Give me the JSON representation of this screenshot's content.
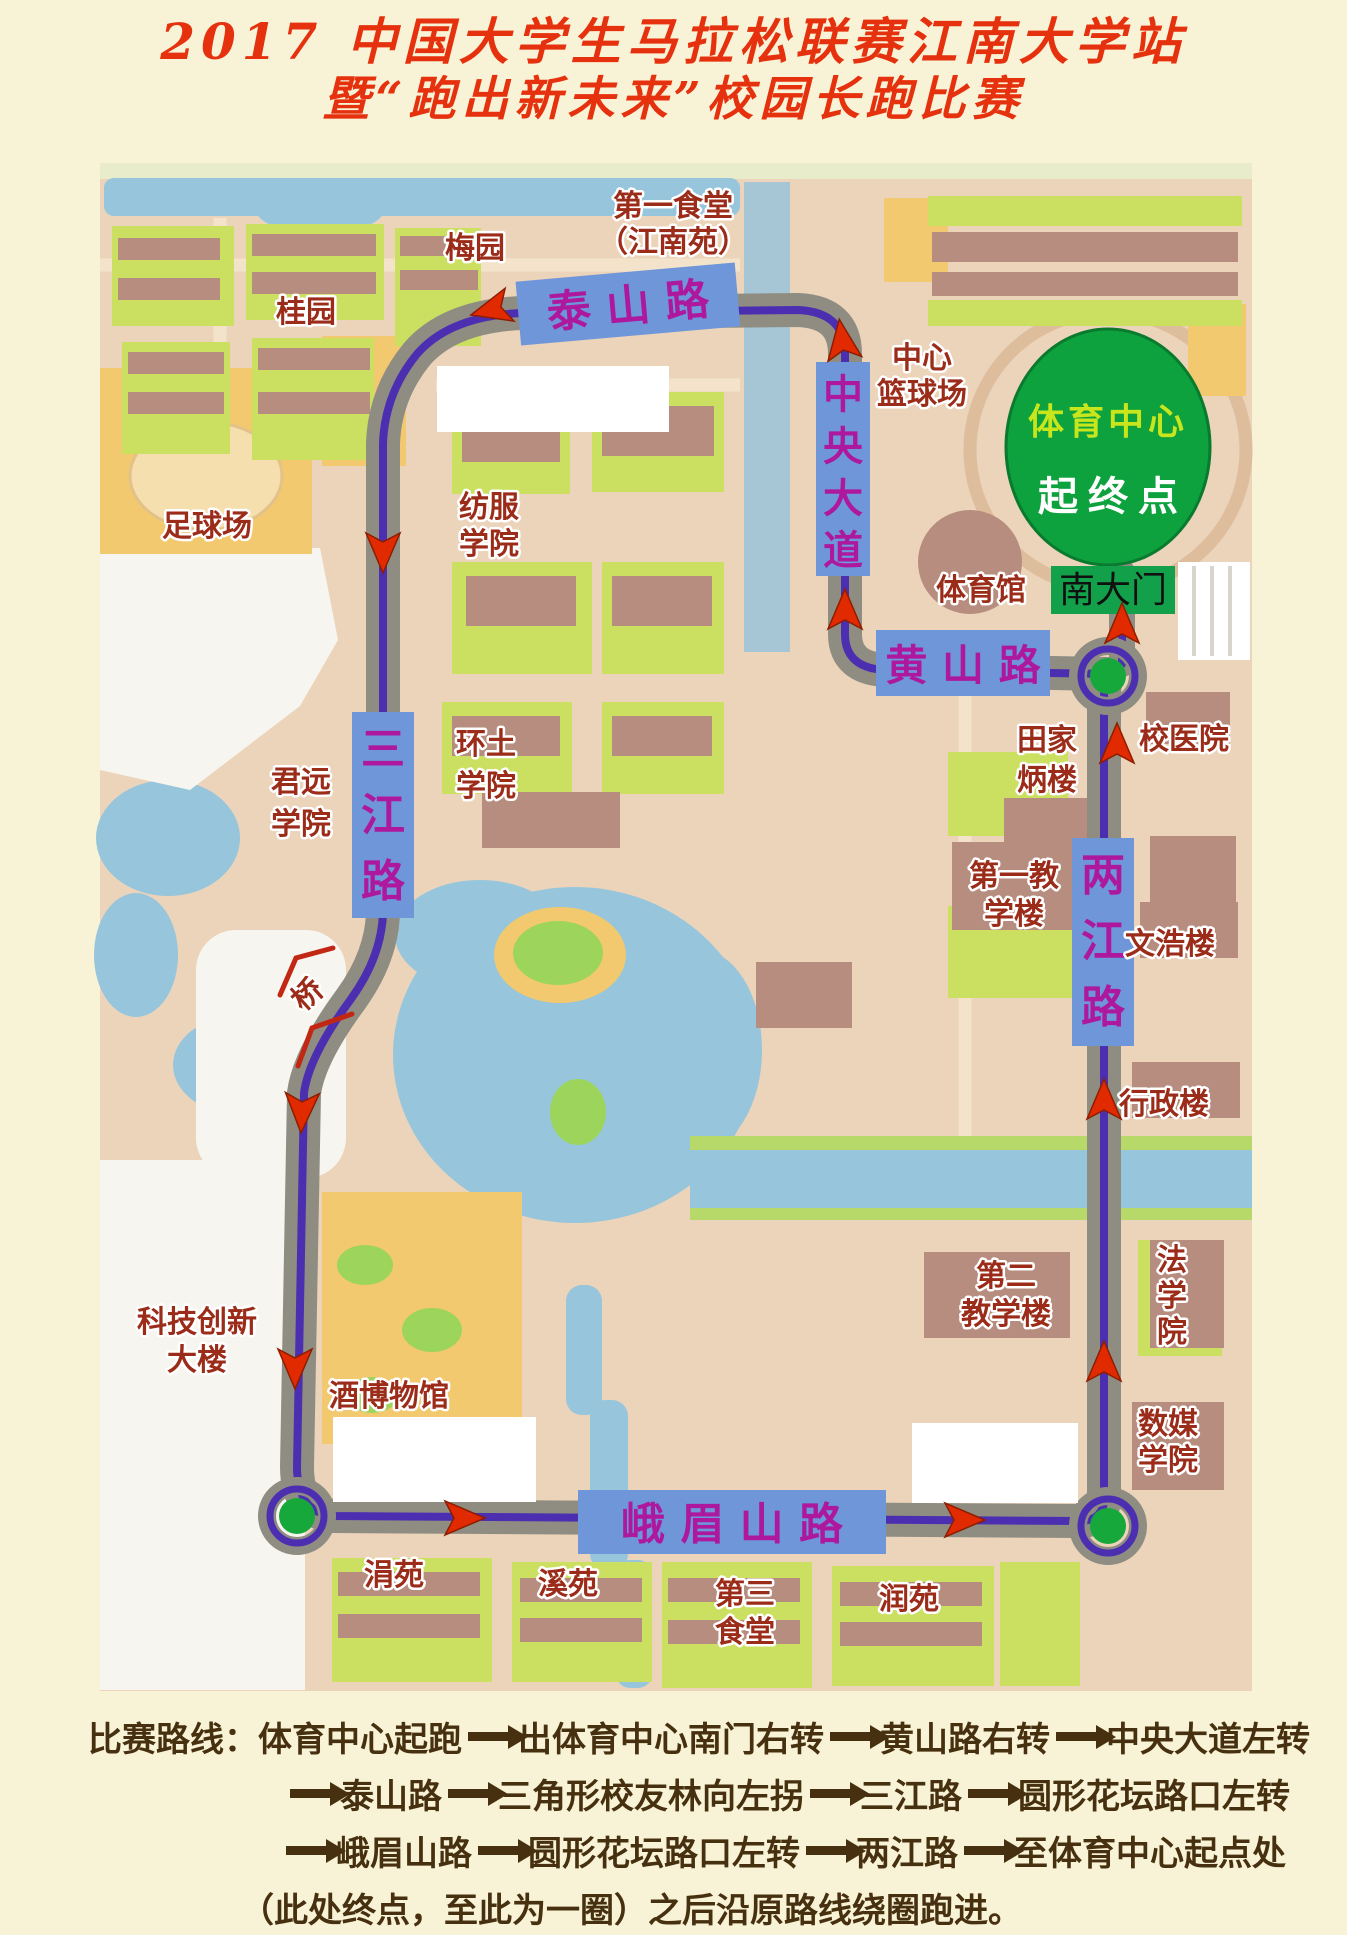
{
  "title": {
    "line1": "2017 中国大学生马拉松联赛江南大学站",
    "line2": "暨“跑出新未来”校园长跑比赛"
  },
  "colors": {
    "title_red": "#e5310e",
    "banner_blue": "#6f96d9",
    "banner_text_magenta": "#ad189e",
    "place_label_maroon": "#9c2c1a",
    "route_purple": "#4b2fb0",
    "road_gray": "#8f8d82",
    "arrow_red": "#e22a00",
    "start_finish_green": "#0da23e",
    "south_gate_green": "#13a04a",
    "footer_text_brown": "#46300f"
  },
  "map": {
    "start_finish": {
      "line1": "体育中心",
      "line2": "起终点"
    },
    "south_gate": "南大门",
    "roads": {
      "taishan": "泰 山 路",
      "zhongyang": [
        "中",
        "央",
        "大",
        "道"
      ],
      "huangshan": "黄 山 路",
      "sanjiang": [
        "三",
        "江",
        "路"
      ],
      "liangjiang": [
        "两",
        "江",
        "路"
      ],
      "emeishan": "峨 眉 山 路"
    },
    "places": {
      "meiyuan": "梅园",
      "guiyuan": "桂园",
      "shitang1a": "第一食堂",
      "shitang1b": "（江南苑）",
      "lanqiu1": "中心",
      "lanqiu2": "篮球场",
      "zuqiuchang": "足球场",
      "fangfu1": "纺服",
      "fangfu2": "学院",
      "tiyuguan": "体育馆",
      "junyuan1": "君远",
      "junyuan2": "学院",
      "huantu1": "环土",
      "huantu2": "学院",
      "tianjiabing1": "田家",
      "tianjiabing2": "炳楼",
      "xiaoyiyuan": "校医院",
      "qiao": "桥",
      "jiao1a": "第一教",
      "jiao1b": "学楼",
      "wenhaolou": "文浩楼",
      "xingzhenglou": "行政楼",
      "jiao2a": "第二",
      "jiao2b": "教学楼",
      "fa1": "法",
      "fa2": "学",
      "fa3": "院",
      "keji1": "科技创新",
      "keji2": "大楼",
      "jiubowuguan": "酒博物馆",
      "shumei1": "数媒",
      "shumei2": "学院",
      "juanyuan": "涓苑",
      "xiyuan": "溪苑",
      "shitang3a": "第三",
      "shitang3b": "食堂",
      "runyuan": "润苑"
    }
  },
  "route_plan": {
    "prefix": "比赛路线：",
    "line1": [
      "体育中心起跑",
      "出体育中心南门右转",
      "黄山路右转",
      "中央大道左转"
    ],
    "line2": [
      "泰山路",
      "三角形校友林向左拐",
      "三江路",
      "圆形花坛路口左转"
    ],
    "line3": [
      "峨眉山路",
      "圆形花坛路口左转",
      "两江路",
      "至体育中心起点处"
    ],
    "line4": "（此处终点，至此为一圈）之后沿原路线绕圈跑进。"
  }
}
